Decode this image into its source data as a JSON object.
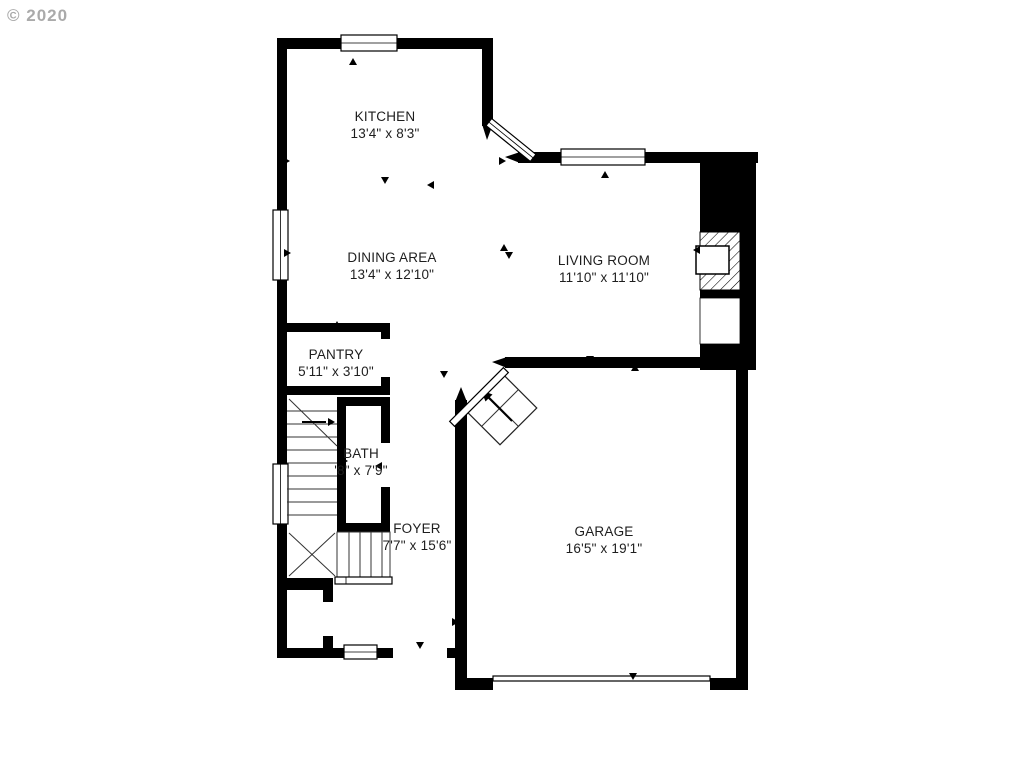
{
  "page": {
    "watermark": "© 2020",
    "type_label": "first-floor residential floor plan"
  },
  "colors": {
    "wall_color": "#000000",
    "text_color": "#1e1e1e",
    "watermark_color": "#9c9c9c",
    "background": "#ffffff"
  },
  "floor_plan": {
    "rooms": [
      {
        "id": "kitchen",
        "name": "KITCHEN",
        "dimensions": "13'4\" x 8'3\""
      },
      {
        "id": "dining-area",
        "name": "DINING AREA",
        "dimensions": "13'4\" x 12'10\""
      },
      {
        "id": "living-room",
        "name": "LIVING ROOM",
        "dimensions": "11'10\" x 11'10\""
      },
      {
        "id": "pantry",
        "name": "PANTRY",
        "dimensions": "5'11\" x 3'10\""
      },
      {
        "id": "bath",
        "name": "BATH",
        "dimensions": "'8\" x 7'9\""
      },
      {
        "id": "foyer",
        "name": "FOYER",
        "dimensions": "7'7\" x 15'6\""
      },
      {
        "id": "garage",
        "name": "GARAGE",
        "dimensions": "16'5\" x 19'1\""
      }
    ]
  }
}
